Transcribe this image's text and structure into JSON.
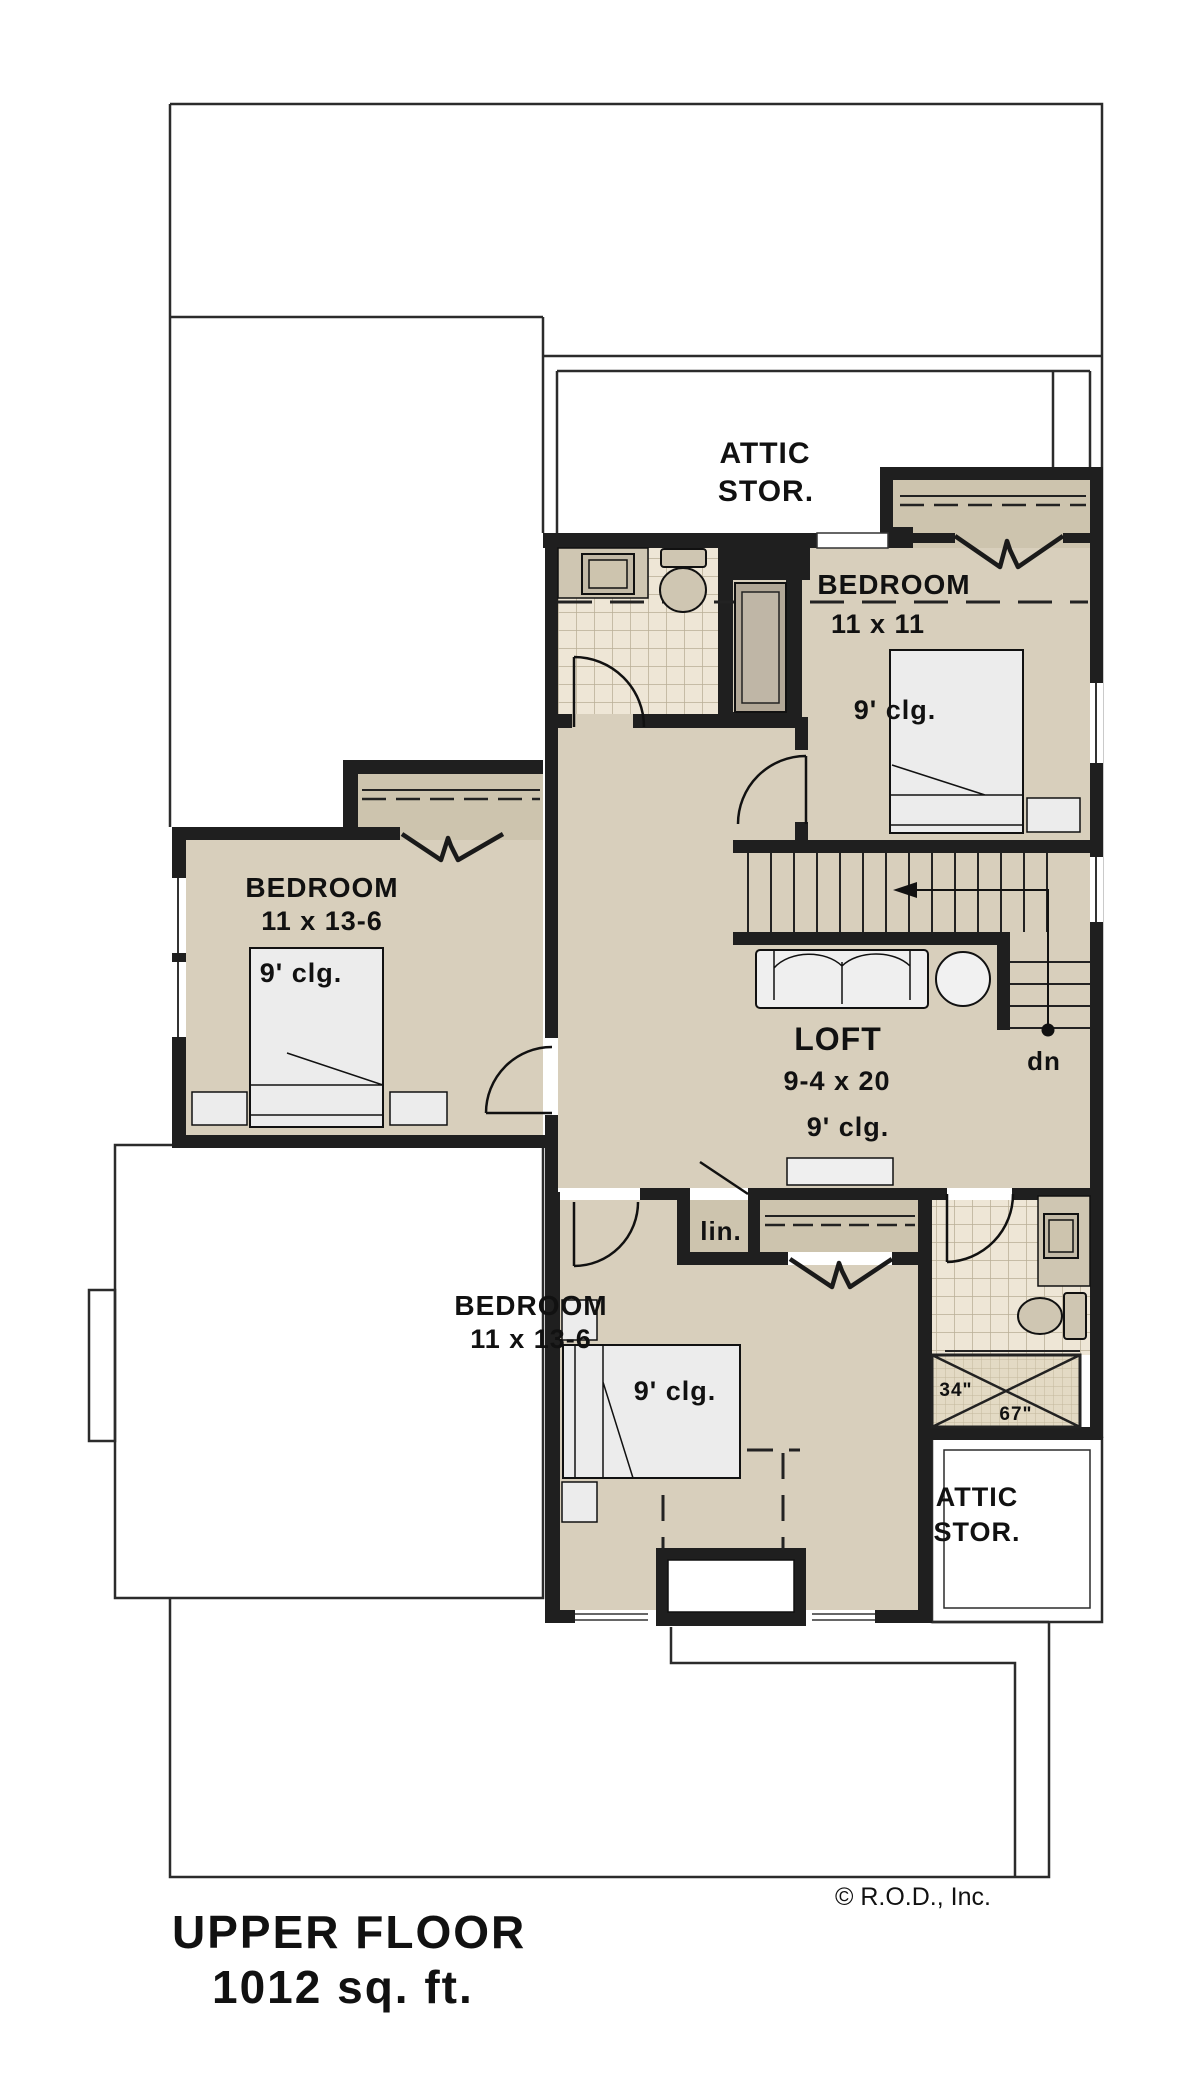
{
  "plan": {
    "labels": {
      "attic_top": {
        "l1": "ATTIC",
        "l2": "STOR."
      },
      "bedroom_right": {
        "name": "BEDROOM",
        "dims": "11 x 11",
        "clg": "9' clg."
      },
      "bedroom_left": {
        "name": "BEDROOM",
        "dims": "11 x 13-6",
        "clg": "9' clg."
      },
      "bedroom_bottom": {
        "name": "BEDROOM",
        "dims": "11 x 13-6",
        "clg": "9' clg."
      },
      "loft": {
        "name": "LOFT",
        "dims": "9-4 x 20",
        "clg": "9' clg."
      },
      "stairs": {
        "down": "dn"
      },
      "linen": {
        "label": "lin."
      },
      "shower": {
        "width": "34\"",
        "length": "67\""
      },
      "attic_bottom": {
        "l1": "ATTIC",
        "l2": "STOR."
      }
    },
    "footer": {
      "copyright": "© R.O.D., Inc.",
      "title_line1": "UPPER FLOOR",
      "title_line2": "1012 sq. ft."
    },
    "colors": {
      "wall": "#1f1f1f",
      "floor_tan": "#d8cfbc",
      "closet_tan": "#cdc4ae",
      "tile": "#eee6d6",
      "tile_grid": "#b9ae97",
      "shower_tile": "#e3dac4",
      "furniture": "#ececec",
      "tub": "#b2a897",
      "outline": "#2b2b2b"
    }
  }
}
